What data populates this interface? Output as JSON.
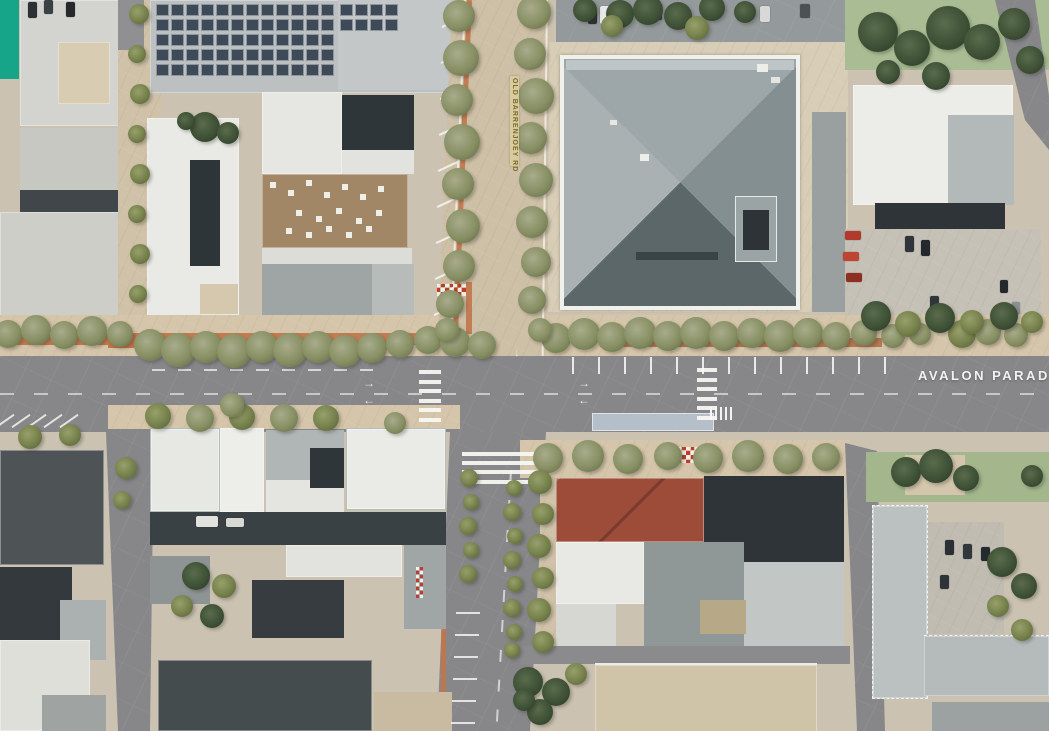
{
  "labels": {
    "avalon_parade": "AVALON PARADE",
    "old_barrenjoey": "OLD BARRENJOEY RD"
  },
  "colors": {
    "accent_teal": "#17A589",
    "road_gray": "#87878A",
    "footpath_tan": "#D5C5AA",
    "shared_paving": "#CEC0A6",
    "terracotta": "#C1754A",
    "terracotta_dark": "#B06A42",
    "tree_olive": "#75804B",
    "tree_dark": "#3F5136",
    "lawn_green": "#A3B68C",
    "roof_light": "#C9CCCB",
    "roof_white": "#EAEAE6",
    "roof_charcoal": "#30373A",
    "roof_red": "#9C4C38",
    "solar_blue": "#3E4A57",
    "bus_stop_blue": "#BCC9D4",
    "marking_white": "#F5F5F2"
  }
}
